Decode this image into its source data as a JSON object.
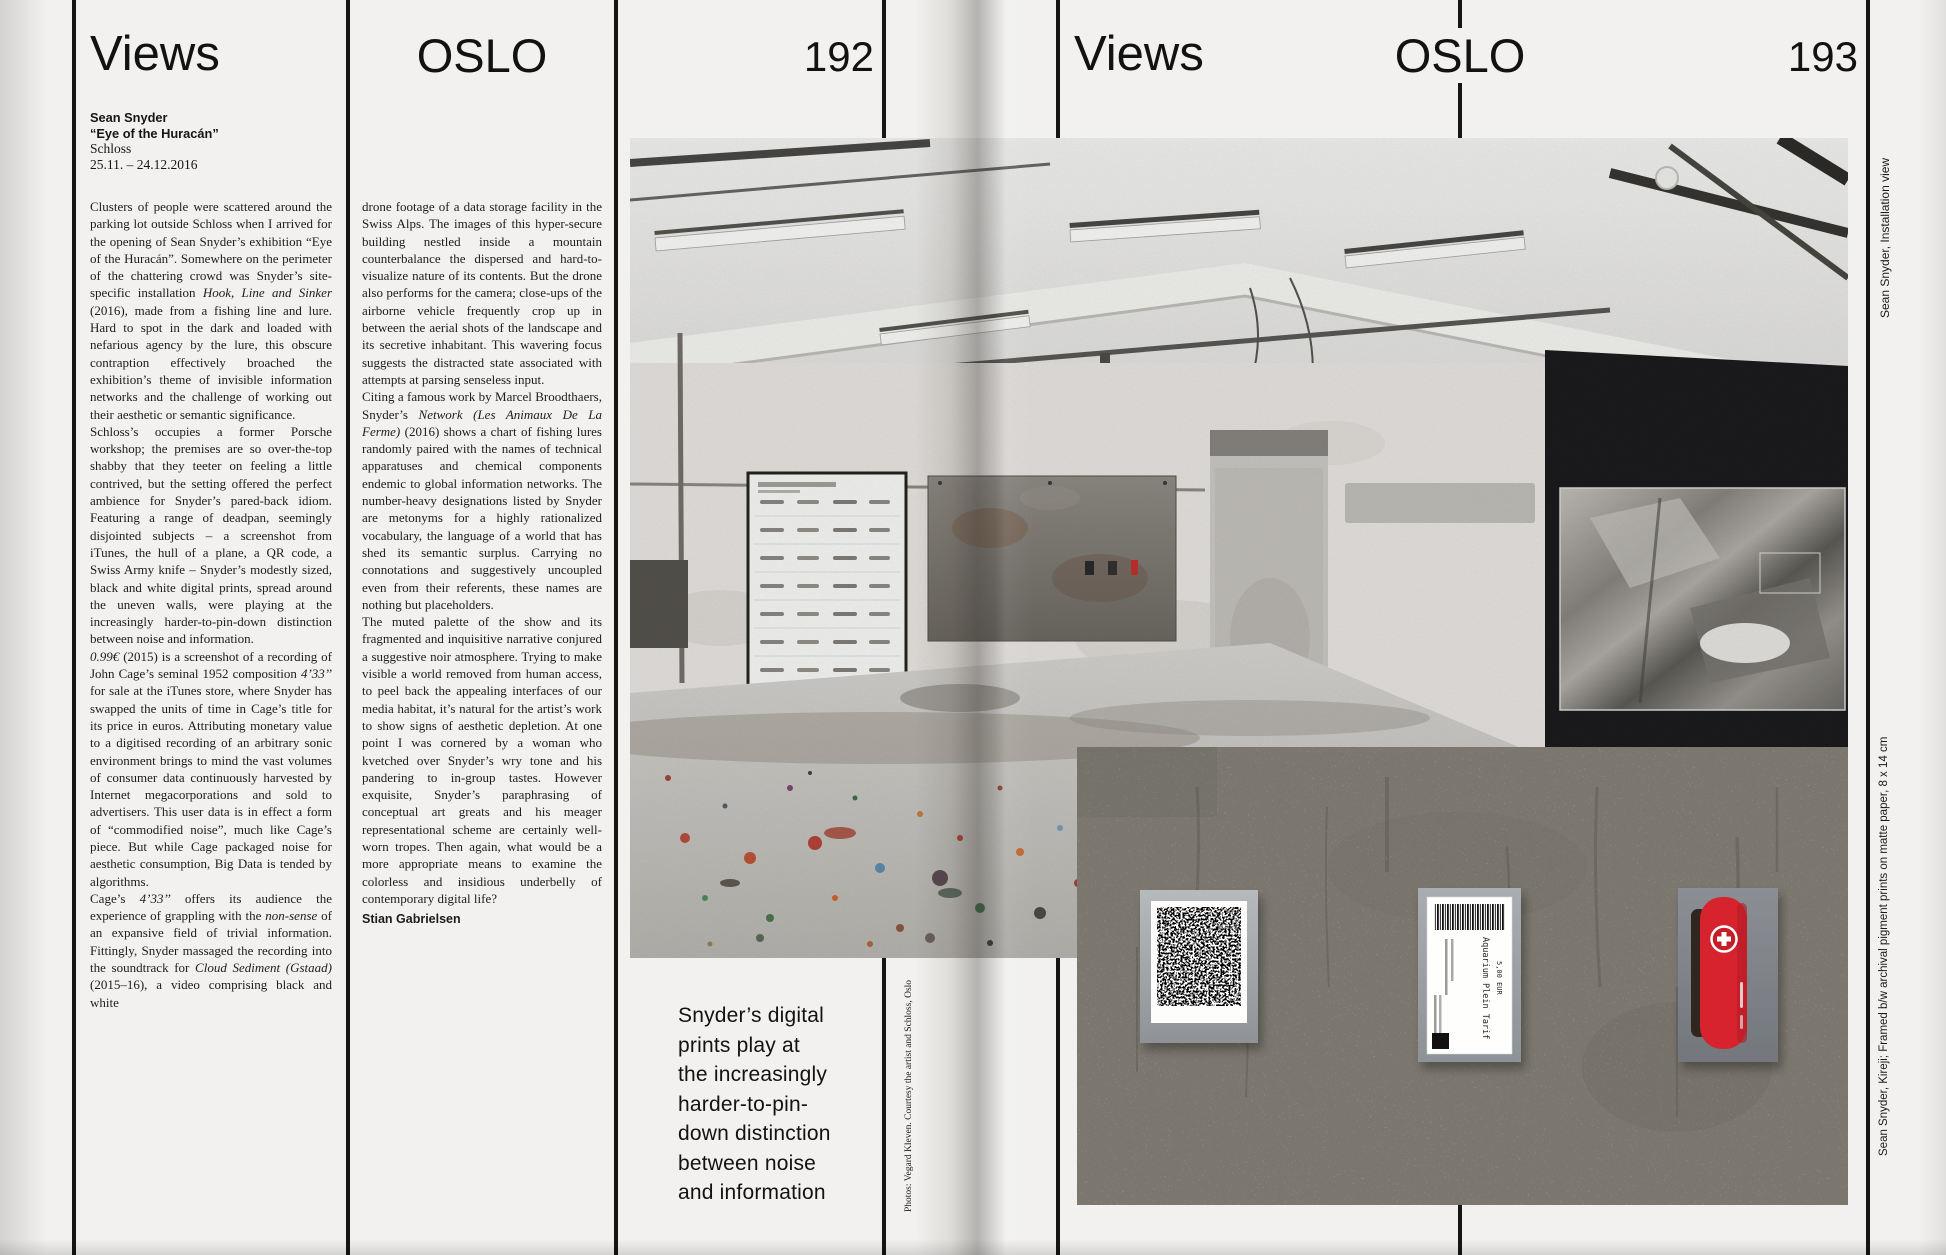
{
  "header": {
    "left": {
      "section": "Views",
      "city": "OSLO",
      "page_number": "192"
    },
    "right": {
      "section": "Views",
      "city": "OSLO",
      "page_number": "193"
    }
  },
  "article": {
    "artist": "Sean Snyder",
    "title": "“Eye of the Huracán”",
    "venue": "Schloss",
    "dates": "25.11. – 24.12.2016",
    "column1": [
      "Clusters of people were scattered around the parking lot outside Schloss when I arrived for the opening of Sean Snyder’s exhibition “Eye of the Huracán”. Somewhere on the perimeter of the chattering crowd was Snyder’s site-specific installation *Hook, Line and Sinker* (2016), made from a fishing line and lure. Hard to spot in the dark and loaded with nefarious agency by the lure, this obscure contraption effectively broached the exhibition’s theme of invisible information networks and the challenge of working out their aesthetic or semantic significance.",
      "Schloss’s occupies a former Porsche workshop; the premises are so over-the-top shabby that they teeter on feeling a little contrived, but the setting offered the perfect ambience for Snyder’s pared-back idiom. Featuring a range of deadpan, seemingly disjointed subjects – a screenshot from iTunes, the hull of a plane, a QR code, a Swiss Army knife – Snyder’s modestly sized, black and white digital prints, spread around the uneven walls, were playing at the increasingly harder-to-pin-down distinction between noise and information.",
      "*0.99€* (2015) is a screenshot of a recording of John Cage’s seminal 1952 composition *4’33’’* for sale at the iTunes store, where Snyder has swapped the units of time in Cage’s title for its price in euros. Attributing monetary value to a digitised recording of an arbitrary sonic environment brings to mind the vast volumes of consumer data continuously harvested by Internet megacorporations and sold to advertisers. This user data is in effect a form of “commodified noise”, much like Cage’s piece. But while Cage packaged noise for aesthetic consumption, Big Data is tended by algorithms.",
      "Cage’s *4’33’’* offers its audience the experience of grappling with the *non-sense* of an expansive field of trivial information. Fittingly, Snyder massaged the recording into the soundtrack for *Cloud Sediment (Gstaad)* (2015–16), a video comprising black and white"
    ],
    "column2": [
      "drone footage of a data storage facility in the Swiss Alps. The images of this hyper-secure building nestled inside a mountain counterbalance the dispersed and hard-to-visualize nature of its contents. But the drone also performs for the camera; close-ups of the airborne vehicle frequently crop up in between the aerial shots of the landscape and its secretive inhabitant. This wavering focus suggests the distracted state associated with attempts at parsing senseless input.",
      "Citing a famous work by Marcel Broodthaers, Snyder’s *Network (Les Animaux De La Ferme)* (2016) shows a chart of fishing lures randomly paired with the names of technical apparatuses and chemical components endemic to global information networks. The number-heavy designations listed by Snyder are metonyms for a highly rationalized vocabulary, the language of a world that has shed its semantic surplus. Carrying no connotations and suggestively uncoupled even from their referents, these names are nothing but placeholders.",
      "The muted palette of the show and its fragmented and inquisitive narrative conjured a suggestive noir atmosphere. Trying to make visible a world removed from human access, to peel back the appealing interfaces of our media habitat, it’s natural for the artist’s work to show signs of aesthetic depletion. At one point I was cornered by a woman who kvetched over Snyder’s wry tone and his pandering to in-group tastes. However exquisite, Snyder’s paraphrasing of conceptual art greats and his meager representational scheme are certainly well-worn tropes. Then again, what would be a more appropriate means to examine the colorless and insidious underbelly of contemporary digital life?"
    ],
    "byline": "Stian Gabrielsen"
  },
  "pull_quote": "Snyder’s digital\nprints play at\nthe increasingly\nharder-to-pin-\ndown distinction\nbetween noise\nand information",
  "captions": {
    "photo_credit": "Photos: Vegard Kleven. Courtesy the artist and Schloss, Oslo",
    "installation_view": "Sean Snyder, Installation view",
    "prints": "Sean Snyder, Kireji; Framed b/w archival pigment prints on matte paper, 8 x 14 cm"
  },
  "artwork_ticket": {
    "line1": "Aquarium Plein Tarif",
    "line2": "5,00 EUR"
  },
  "colors": {
    "page_bg": "#f2f1ef",
    "rule": "#151515",
    "dark_wall": "#1c1c1e",
    "concrete": "#b2aca1",
    "knife_red": "#d6232e",
    "plaque_gray": "#9aa0a5"
  }
}
